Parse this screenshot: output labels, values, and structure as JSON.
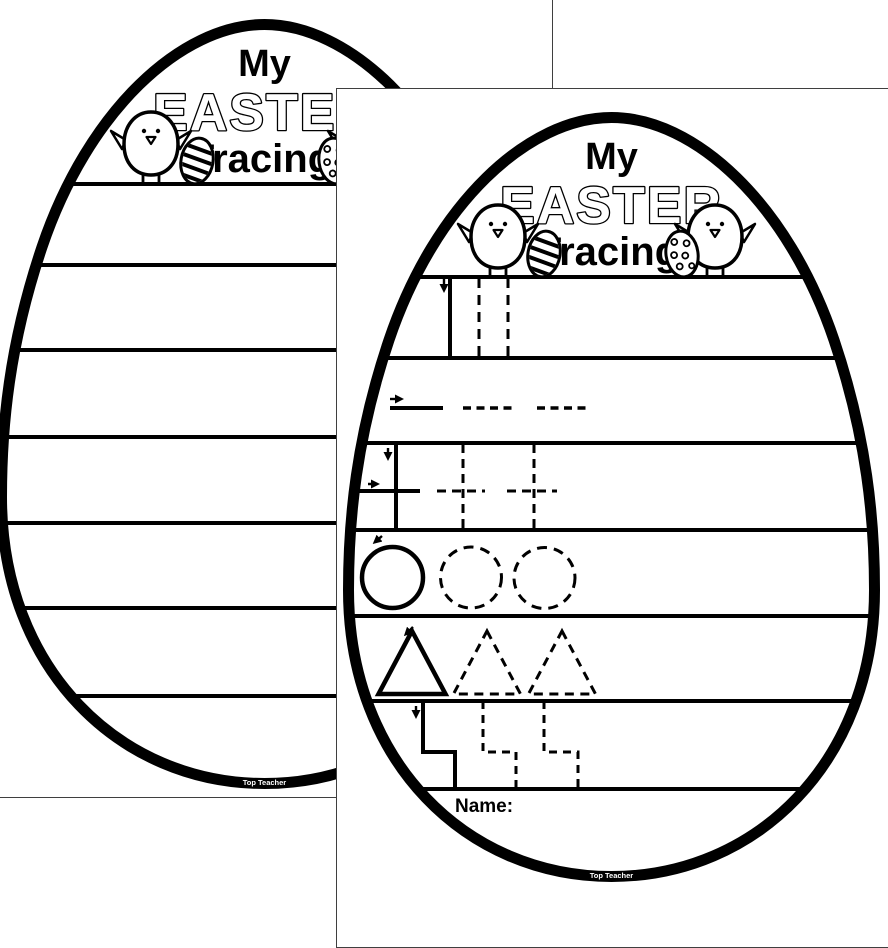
{
  "worksheet": {
    "title_top": "My",
    "title_main": "EASTER",
    "title_sub": "Tracing",
    "name_label": "Name:",
    "brand": "Top Teacher",
    "tracing_rows": [
      "vertical-line",
      "horizontal-line",
      "cross",
      "circle",
      "triangle",
      "step"
    ]
  },
  "pages": {
    "back": "blank lined egg page",
    "front": "shape tracing egg page"
  },
  "colors": {
    "ink": "#000000",
    "paper": "#ffffff",
    "page_edge": "#3f3f3f"
  }
}
